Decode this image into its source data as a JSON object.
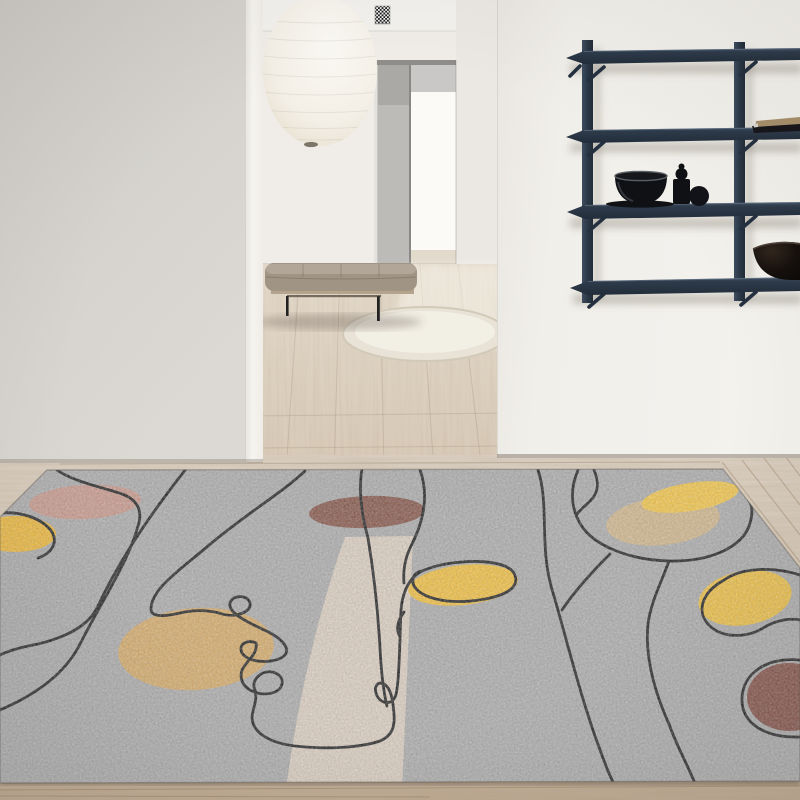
{
  "scene": {
    "description": "Minimalist interior hallway with pendant paper lantern, navy wall shelf, daybed bench, round cream rug, wood floor and large gray abstract line-art area rug",
    "objects": [
      "left wall",
      "hallway doorway",
      "paper pendant lantern",
      "air vent grille",
      "navy wall-mounted shelf",
      "black bowl",
      "black jar",
      "black sphere",
      "book",
      "large dark bowl",
      "daybed bench",
      "round cream rug",
      "wood floor",
      "gray abstract rug with line art and color blobs"
    ]
  },
  "colors": {
    "leftWall": "#d5d2cd",
    "leftWallEdge": "#f5f3ef",
    "hallWall": "#f0ede9",
    "hallWallSide": "#ebe8e3",
    "rightWall": "#f2f0eb",
    "ceiling": "#f3f1ed",
    "doorPanel": "#bdbbb8",
    "doorEdge": "#8f8d8a",
    "doorwayLight": "#fbfaf7",
    "doorwayTop": "#c9c8c6",
    "lantern": "#f5f2ea",
    "lanternNub": "#7d756a",
    "ventDark": "#1c1c1c",
    "ventLight": "#f2f2f2",
    "shelfNavy": "#2c3949",
    "shelfNavyLight": "#4a5b70",
    "shelfNavyDark": "#1e2835",
    "bookTan": "#a8906b",
    "bookDark": "#17161a",
    "bookPages": "#d9d5cd",
    "objectBlack": "#101114",
    "bowlRim": "#5a5f66",
    "bigBowlBrown": "#1c1410",
    "bigBowlRim": "#4e423a",
    "benchCushion": "#a09484",
    "benchBase": "#b5a48d",
    "benchLeg": "#222222",
    "roundRug": "#e8e3d6",
    "hallFloor": "#ddd2c2",
    "foreFloor": "#d4c7b6",
    "floorDarkStrip": "#c4b099",
    "rugBase": "#a6a6a6",
    "rugLine": "#141414",
    "rugPink": "#c59183",
    "rugYellowLeft": "#efb42a",
    "rugBrown": "#7e4a3c",
    "rugYellowTop": "#f2c23b",
    "rugTan": "#cdb183",
    "rugYellowPill": "#f0ba32",
    "rugYellowRight": "#eebc35",
    "rugBrownRight": "#7a4238",
    "rugCamel": "#d3a55e",
    "rugBeige": "#d9cbbb"
  }
}
